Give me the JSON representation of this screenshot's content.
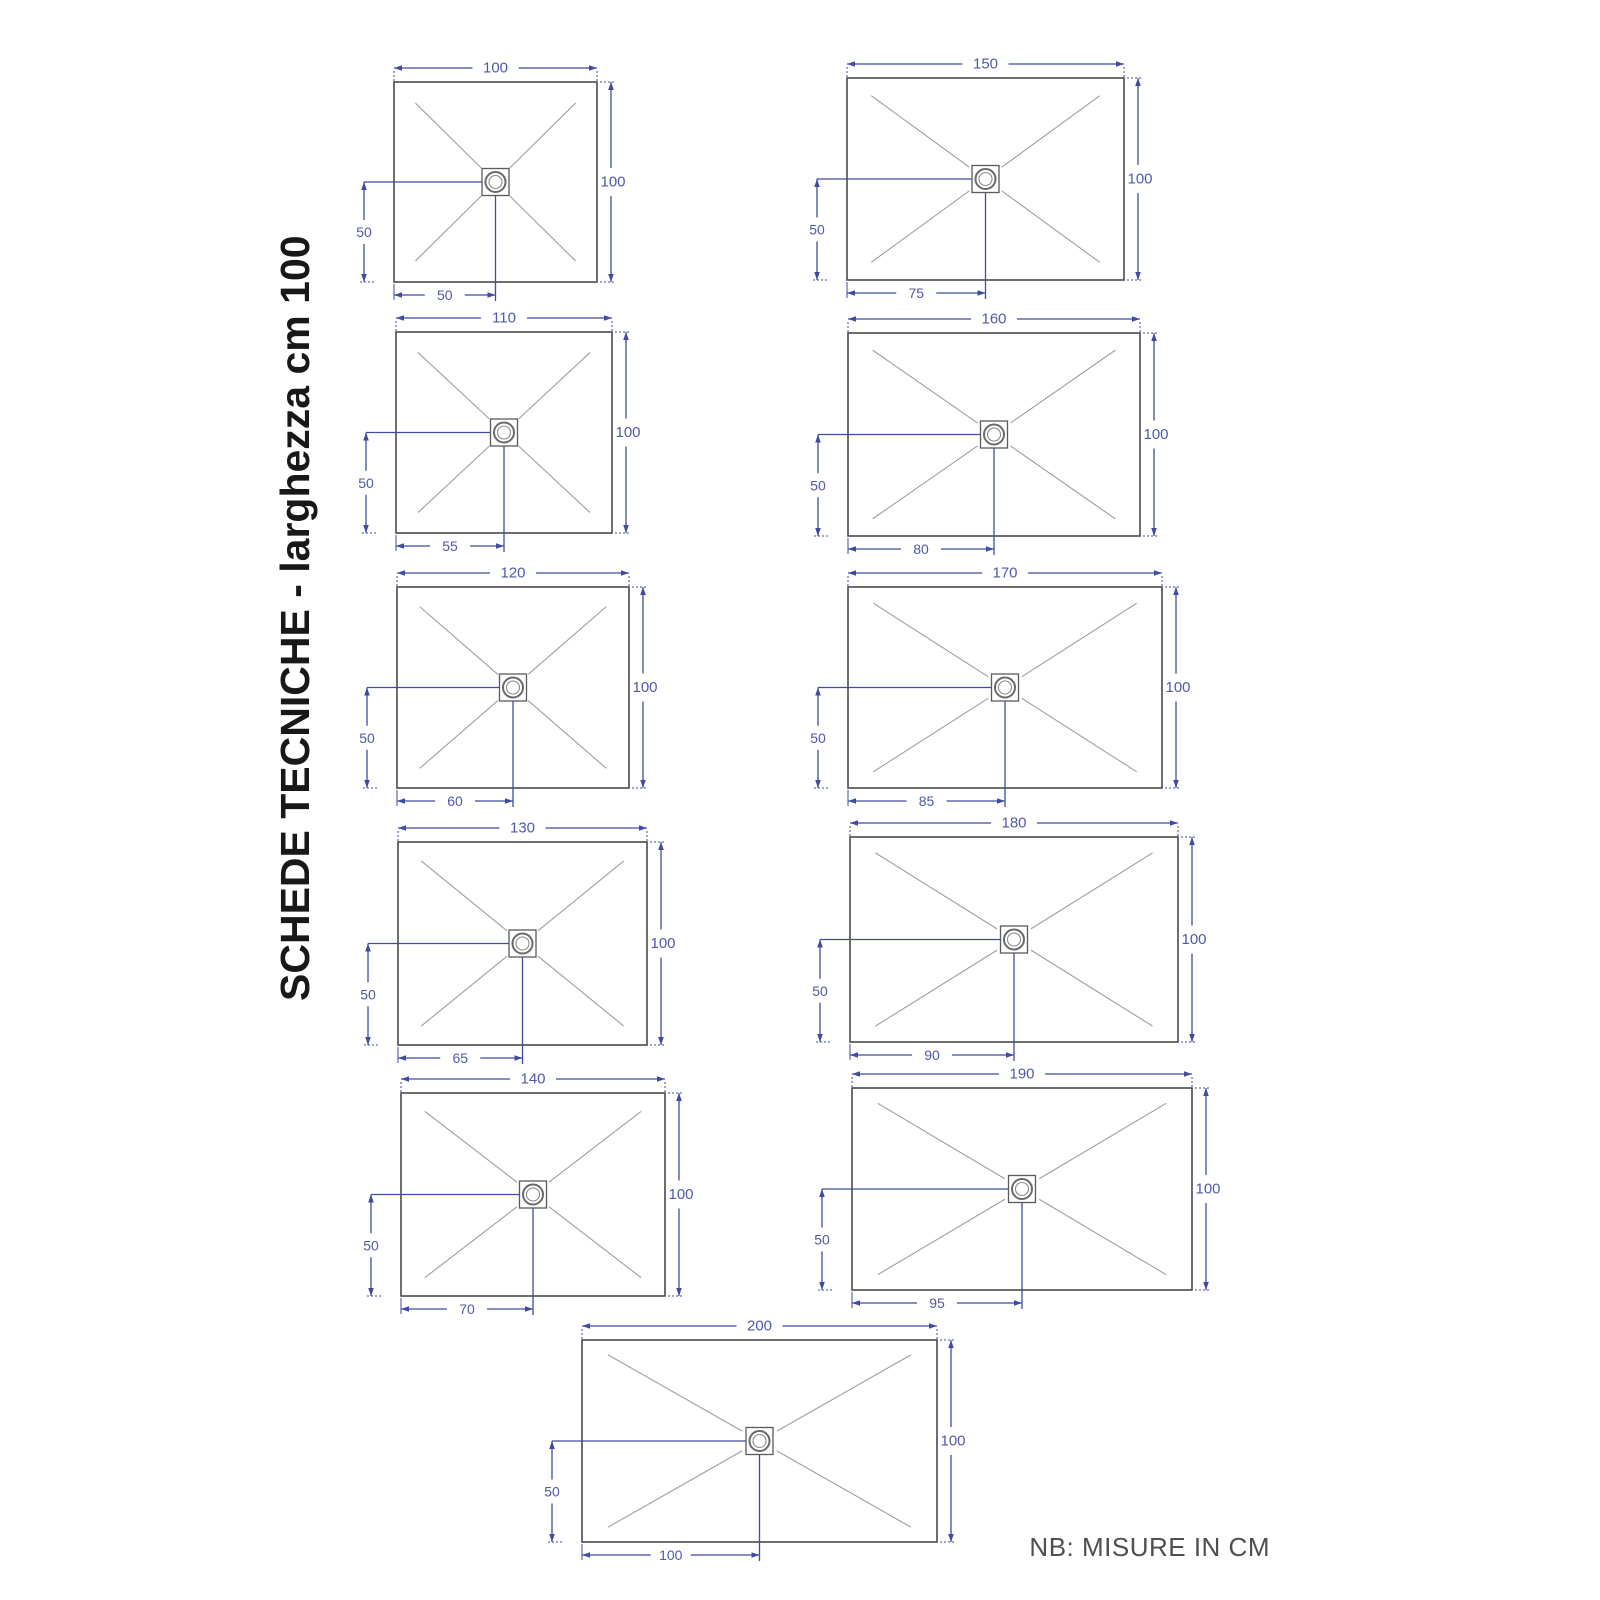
{
  "title": "SCHEDE TECNICHE - larghezza cm 100",
  "note": "NB: MISURE IN CM",
  "colors": {
    "dimension_line": "#3f4ba0",
    "dimension_text": "#5158a8",
    "tray_outline": "#4a4a4a",
    "diagonal_line": "#9e9e9e",
    "drain_outline": "#5a5a5a",
    "title_text": "#181818",
    "note_text": "#4f4f4f",
    "background": "#ffffff"
  },
  "trays": [
    {
      "width_cm": "100",
      "height_cm": "100",
      "drain_from_left_cm": "50",
      "drain_from_bottom_cm": "50",
      "layout": {
        "x": 394,
        "y": 82,
        "w": 203,
        "h": 200
      }
    },
    {
      "width_cm": "110",
      "height_cm": "100",
      "drain_from_left_cm": "55",
      "drain_from_bottom_cm": "50",
      "layout": {
        "x": 396,
        "y": 332,
        "w": 216,
        "h": 201
      }
    },
    {
      "width_cm": "120",
      "height_cm": "100",
      "drain_from_left_cm": "60",
      "drain_from_bottom_cm": "50",
      "layout": {
        "x": 397,
        "y": 587,
        "w": 232,
        "h": 201
      }
    },
    {
      "width_cm": "130",
      "height_cm": "100",
      "drain_from_left_cm": "65",
      "drain_from_bottom_cm": "50",
      "layout": {
        "x": 398,
        "y": 842,
        "w": 249,
        "h": 203
      }
    },
    {
      "width_cm": "140",
      "height_cm": "100",
      "drain_from_left_cm": "70",
      "drain_from_bottom_cm": "50",
      "layout": {
        "x": 401,
        "y": 1093,
        "w": 264,
        "h": 203
      }
    },
    {
      "width_cm": "150",
      "height_cm": "100",
      "drain_from_left_cm": "75",
      "drain_from_bottom_cm": "50",
      "layout": {
        "x": 847,
        "y": 78,
        "w": 277,
        "h": 202
      }
    },
    {
      "width_cm": "160",
      "height_cm": "100",
      "drain_from_left_cm": "80",
      "drain_from_bottom_cm": "50",
      "layout": {
        "x": 848,
        "y": 333,
        "w": 292,
        "h": 203
      }
    },
    {
      "width_cm": "170",
      "height_cm": "100",
      "drain_from_left_cm": "85",
      "drain_from_bottom_cm": "50",
      "layout": {
        "x": 848,
        "y": 587,
        "w": 314,
        "h": 201
      }
    },
    {
      "width_cm": "180",
      "height_cm": "100",
      "drain_from_left_cm": "90",
      "drain_from_bottom_cm": "50",
      "layout": {
        "x": 850,
        "y": 837,
        "w": 328,
        "h": 205
      }
    },
    {
      "width_cm": "190",
      "height_cm": "100",
      "drain_from_left_cm": "95",
      "drain_from_bottom_cm": "50",
      "layout": {
        "x": 852,
        "y": 1088,
        "w": 340,
        "h": 202
      }
    },
    {
      "width_cm": "200",
      "height_cm": "100",
      "drain_from_left_cm": "100",
      "drain_from_bottom_cm": "50",
      "layout": {
        "x": 582,
        "y": 1340,
        "w": 355,
        "h": 202
      }
    }
  ]
}
